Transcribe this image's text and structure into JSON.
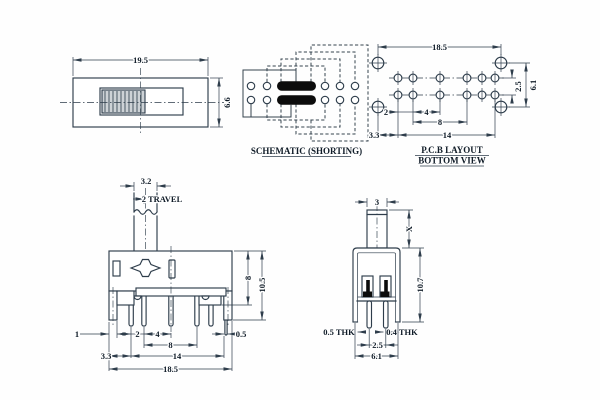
{
  "colors": {
    "line": "#2e3d4b",
    "text": "#101c28",
    "black_fill": "#0c0c0c",
    "knob_fill": "#cdd2d6",
    "background": "#ffffff"
  },
  "drawing": {
    "top_view": {
      "dim_width": "19.5",
      "dim_height": "6.6"
    },
    "schematic": {
      "caption": "SCHEMATIC (SHORTING)"
    },
    "pcb": {
      "dim_total": "18.5",
      "dim_row_pitch": "2.5",
      "dim_hole_span": "6.1",
      "dim_p12": "2",
      "dim_p23": "4",
      "dim_p8": "8",
      "dim_p14": "14",
      "dim_edge": "3.3",
      "caption1": "P.C.B LAYOUT",
      "caption2": "BOTTOM VIEW"
    },
    "front_view": {
      "dim_stem": "3.2",
      "dim_travel": "2 TRAVEL",
      "dim_body8": "8",
      "dim_total_h": "10.5",
      "dim_leg": "1",
      "dim_p12": "2",
      "dim_p23": "4",
      "dim_p8": "8",
      "dim_p14": "14",
      "dim_edge": "3.3",
      "dim_total_w": "18.5",
      "dim_pin_thk": "0.5"
    },
    "side_view": {
      "dim_stem": "3",
      "dim_stem_h": "X",
      "dim_body_h": "10.7",
      "dim_leg_thk": "0.5 THK",
      "dim_pin_thk": "0.4 THK",
      "dim_pin_pitch": "2.5",
      "dim_leg_span": "6.1"
    }
  }
}
